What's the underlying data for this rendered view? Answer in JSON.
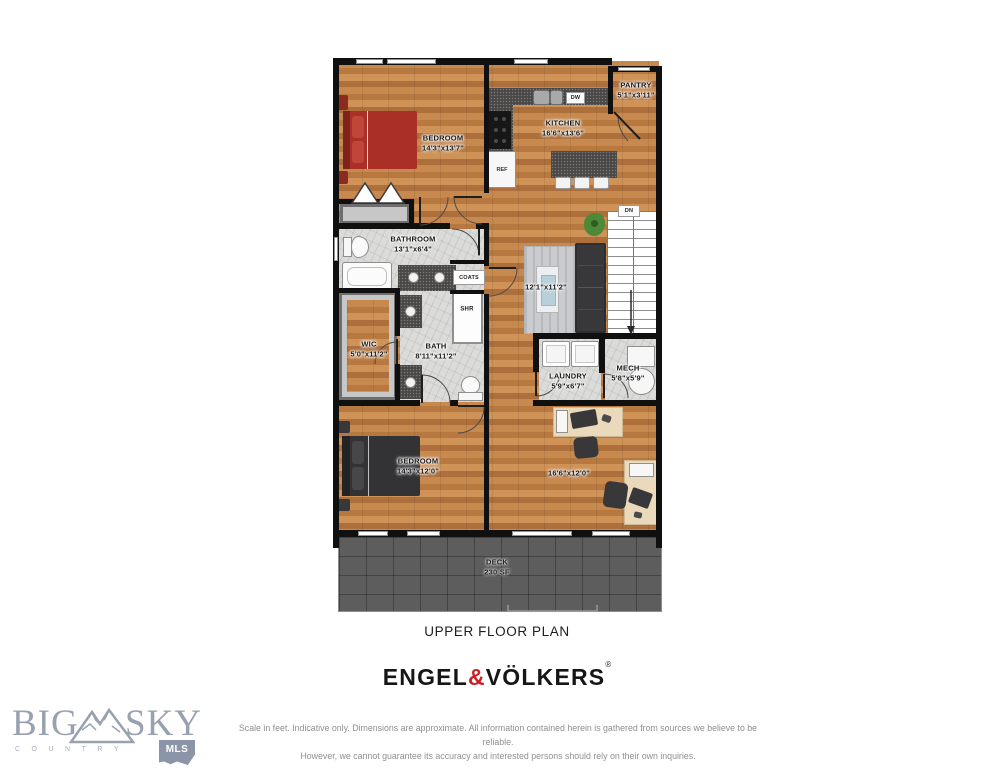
{
  "floorplan": {
    "title": "UPPER FLOOR PLAN",
    "rooms": {
      "bedroom1": {
        "name": "BEDROOM",
        "dims": "14'3\"x13'7\""
      },
      "kitchen": {
        "name": "KITCHEN",
        "dims": "16'6\"x13'6\""
      },
      "pantry": {
        "name": "PANTRY",
        "dims": "5'1\"x3'11\""
      },
      "bathroom": {
        "name": "BATHROOM",
        "dims": "13'1\"x6'4\""
      },
      "wic": {
        "name": "WIC",
        "dims": "5'0\"x11'2\""
      },
      "bath": {
        "name": "BATH",
        "dims": "8'11\"x11'2\""
      },
      "living": {
        "dims": "12'1\"x11'2\""
      },
      "laundry": {
        "name": "LAUNDRY",
        "dims": "5'9\"x6'7\""
      },
      "mech": {
        "name": "MECH",
        "dims": "5'8\"x5'9\""
      },
      "bedroom2": {
        "name": "BEDROOM",
        "dims": "14'3\"x12'0\""
      },
      "flex": {
        "dims": "16'6\"x12'0\""
      },
      "deck": {
        "name": "DECK",
        "dims": "230 SF"
      }
    },
    "fixtures": {
      "ref": "REF",
      "dw": "DW",
      "dn": "DN",
      "shr": "SHR",
      "coats": "COATS"
    }
  },
  "branding": {
    "brokerage": {
      "part1": "ENGEL",
      "amp": "&",
      "part2": "VÖLKERS",
      "reg": "®",
      "accent_color": "#cc1f26"
    },
    "mls": {
      "word1": "BIG",
      "word2": "SKY",
      "sub": "COUNTRY",
      "badge": "MLS",
      "color": "#99a1b1"
    }
  },
  "disclaimer": {
    "line1": "Scale in feet. Indicative only. Dimensions are approximate. All information contained herein is gathered from sources we believe to be reliable.",
    "line2": "However, we cannot guarantee its accuracy and interested persons should rely on their own inquiries."
  }
}
